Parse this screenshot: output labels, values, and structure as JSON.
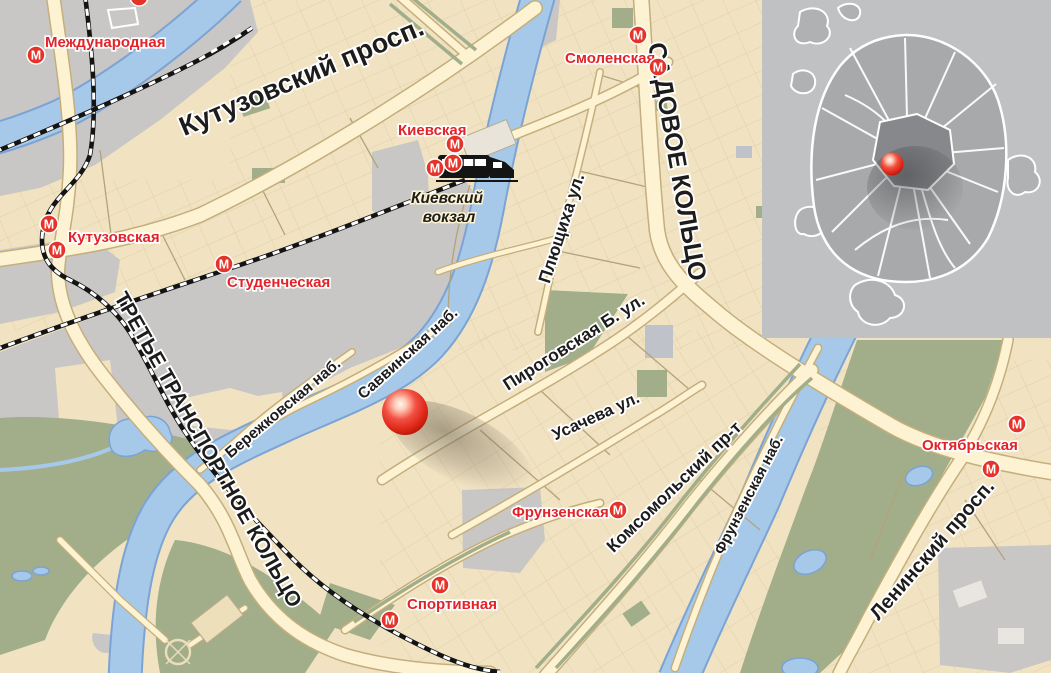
{
  "map_title": "Карта района: место на Саввинской набережной, Москва",
  "metro_icon_glyph": "М",
  "stations": [
    {
      "id": "mezhdunarodnaya",
      "name": "Международная"
    },
    {
      "id": "kutuzovskaya",
      "name": "Кутузовская"
    },
    {
      "id": "studencheskaya",
      "name": "Студенческая"
    },
    {
      "id": "kievskaya",
      "name": "Киевская"
    },
    {
      "id": "smolenskaya",
      "name": "Смоленская"
    },
    {
      "id": "frunzenskaya",
      "name": "Фрунзенская"
    },
    {
      "id": "sportivnaya",
      "name": "Спортивная"
    },
    {
      "id": "oktyabrskaya",
      "name": "Октябрьская"
    }
  ],
  "streets": {
    "kutuzovsky": "Кутузовский просп.",
    "sadovoe": "САДОВОЕ КОЛЬЦО",
    "ttk": "ТРЕТЬЕ ТРАНСПОРТНОЕ КОЛЬЦО",
    "plyushchikha": "Плющиха ул.",
    "pirogovskaya": "Пироговская Б. ул.",
    "usacheva": "Усачева ул.",
    "savvinskaya": "Саввинская наб.",
    "berezhkovskaya": "Бережковская наб.",
    "komsomolsky": "Комсомольский пр-т",
    "frunzenskaya_nab": "Фрунзенская наб.",
    "leninsky": "Ленинский просп."
  },
  "places": {
    "kievsky_line1": "Киевский",
    "kievsky_line2": "вокзал"
  },
  "colors": {
    "land": "#f1e3c2",
    "road_fill": "#fdf3d2",
    "road_casing": "#c4ae7d",
    "water": "#a6c9e9",
    "water_edge": "#7ba3d4",
    "park_green": "#a2ad89",
    "urban_gray": "#c9c7c5",
    "railway_black": "#141414",
    "metro_red": "#e2232a",
    "marker_red": "#e63022",
    "inset_bg": "#c0c1c3",
    "inset_city": "#a8a9ab",
    "inset_center": "#87888b"
  }
}
